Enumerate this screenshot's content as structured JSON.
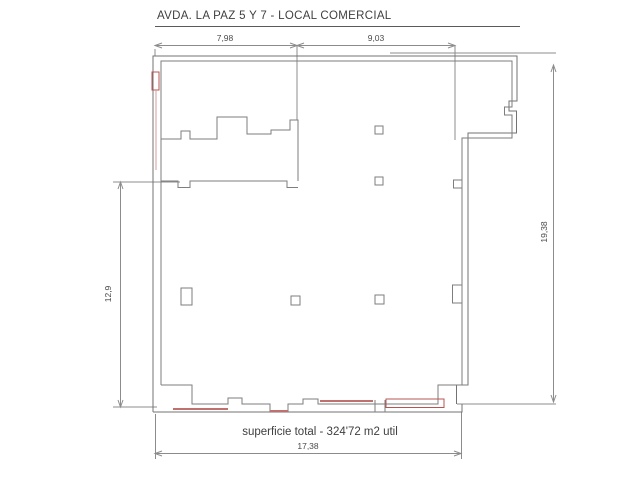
{
  "title": "AVDA. LA PAZ 5 Y 7 - LOCAL COMERCIAL",
  "area_note": "superficie total - 324'72 m2 util",
  "dimensions": {
    "top_left_segment": "7,98",
    "top_right_segment": "9,03",
    "left_height": "12,9",
    "right_height": "19,38",
    "bottom_width": "17,38"
  },
  "colors": {
    "wall_line": "#737373",
    "dimension_line": "#8c8c8c",
    "text": "#3f3f3f",
    "accent_red": "#b85450",
    "accent_red_fill": "#f6eceb"
  },
  "drawing_type": "floor-plan",
  "units_note": "m2"
}
